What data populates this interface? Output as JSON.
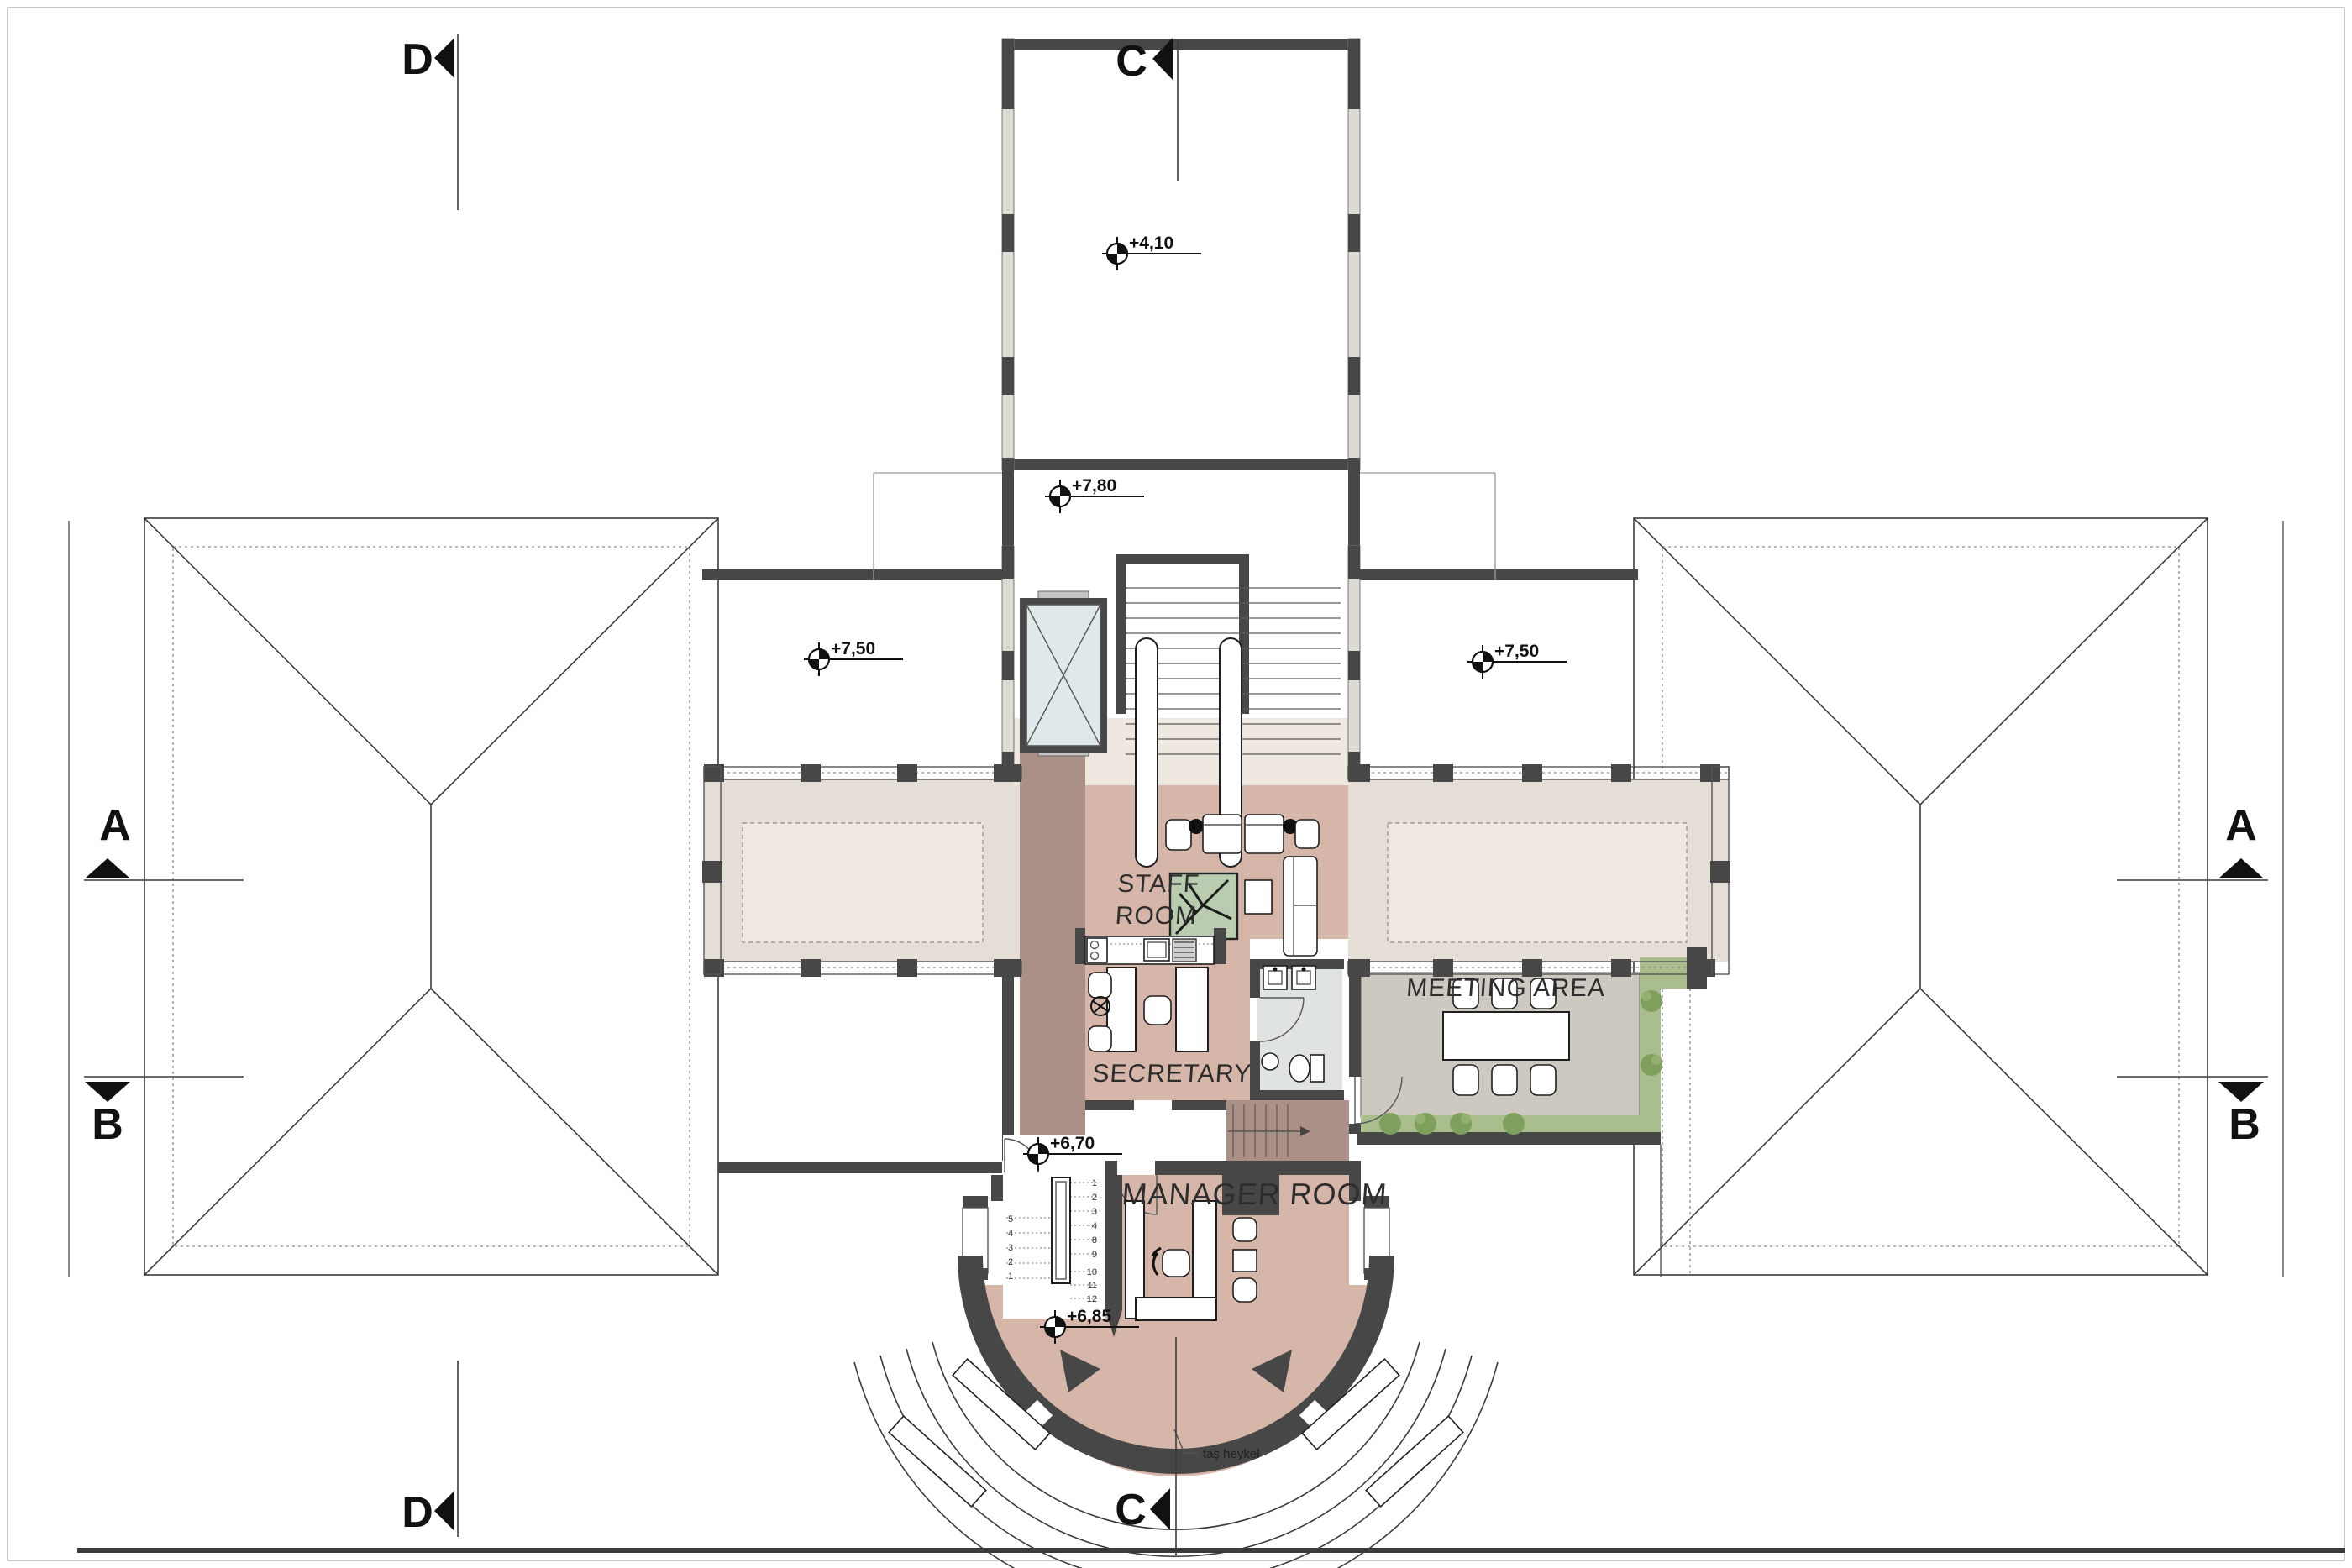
{
  "title": "Upper floor plan",
  "sections": {
    "d_top": "D",
    "d_bottom": "D",
    "c_top": "C",
    "c_bottom": "C",
    "a_left": "A",
    "b_left": "B",
    "a_right": "A",
    "b_right": "B"
  },
  "elevations": {
    "tower": "+4,10",
    "hall": "+7,80",
    "left_wing": "+7,50",
    "right_wing": "+7,50",
    "stair_upper": "+6,70",
    "stair_lower": "+6,85"
  },
  "rooms": {
    "staff_line1": "STAFF",
    "staff_line2": "ROOM",
    "secretary": "SECRETARY",
    "meeting": "MEETING AREA",
    "manager": "MANAGER ROOM"
  },
  "annotations": {
    "statue": "taş heykel"
  },
  "stairs": {
    "right_numbers": [
      "1",
      "2",
      "3",
      "4",
      "8",
      "9",
      "10",
      "11",
      "12"
    ],
    "left_numbers": [
      "5",
      "4",
      "3",
      "2",
      "1"
    ]
  },
  "colors": {
    "wall": "#474747",
    "pink": "#d7b6aa",
    "taupe": "#aa9087",
    "cream": "#eee8e0",
    "corridor": "#e4ded6",
    "court": "#efe9e1",
    "meet": "#cdc8c0",
    "green": "#a9bd8d",
    "plant": "#7fa05c",
    "elev": "#dfe9e9",
    "wc": "#e0e4e1",
    "pgreen": "#b9ccb0"
  }
}
